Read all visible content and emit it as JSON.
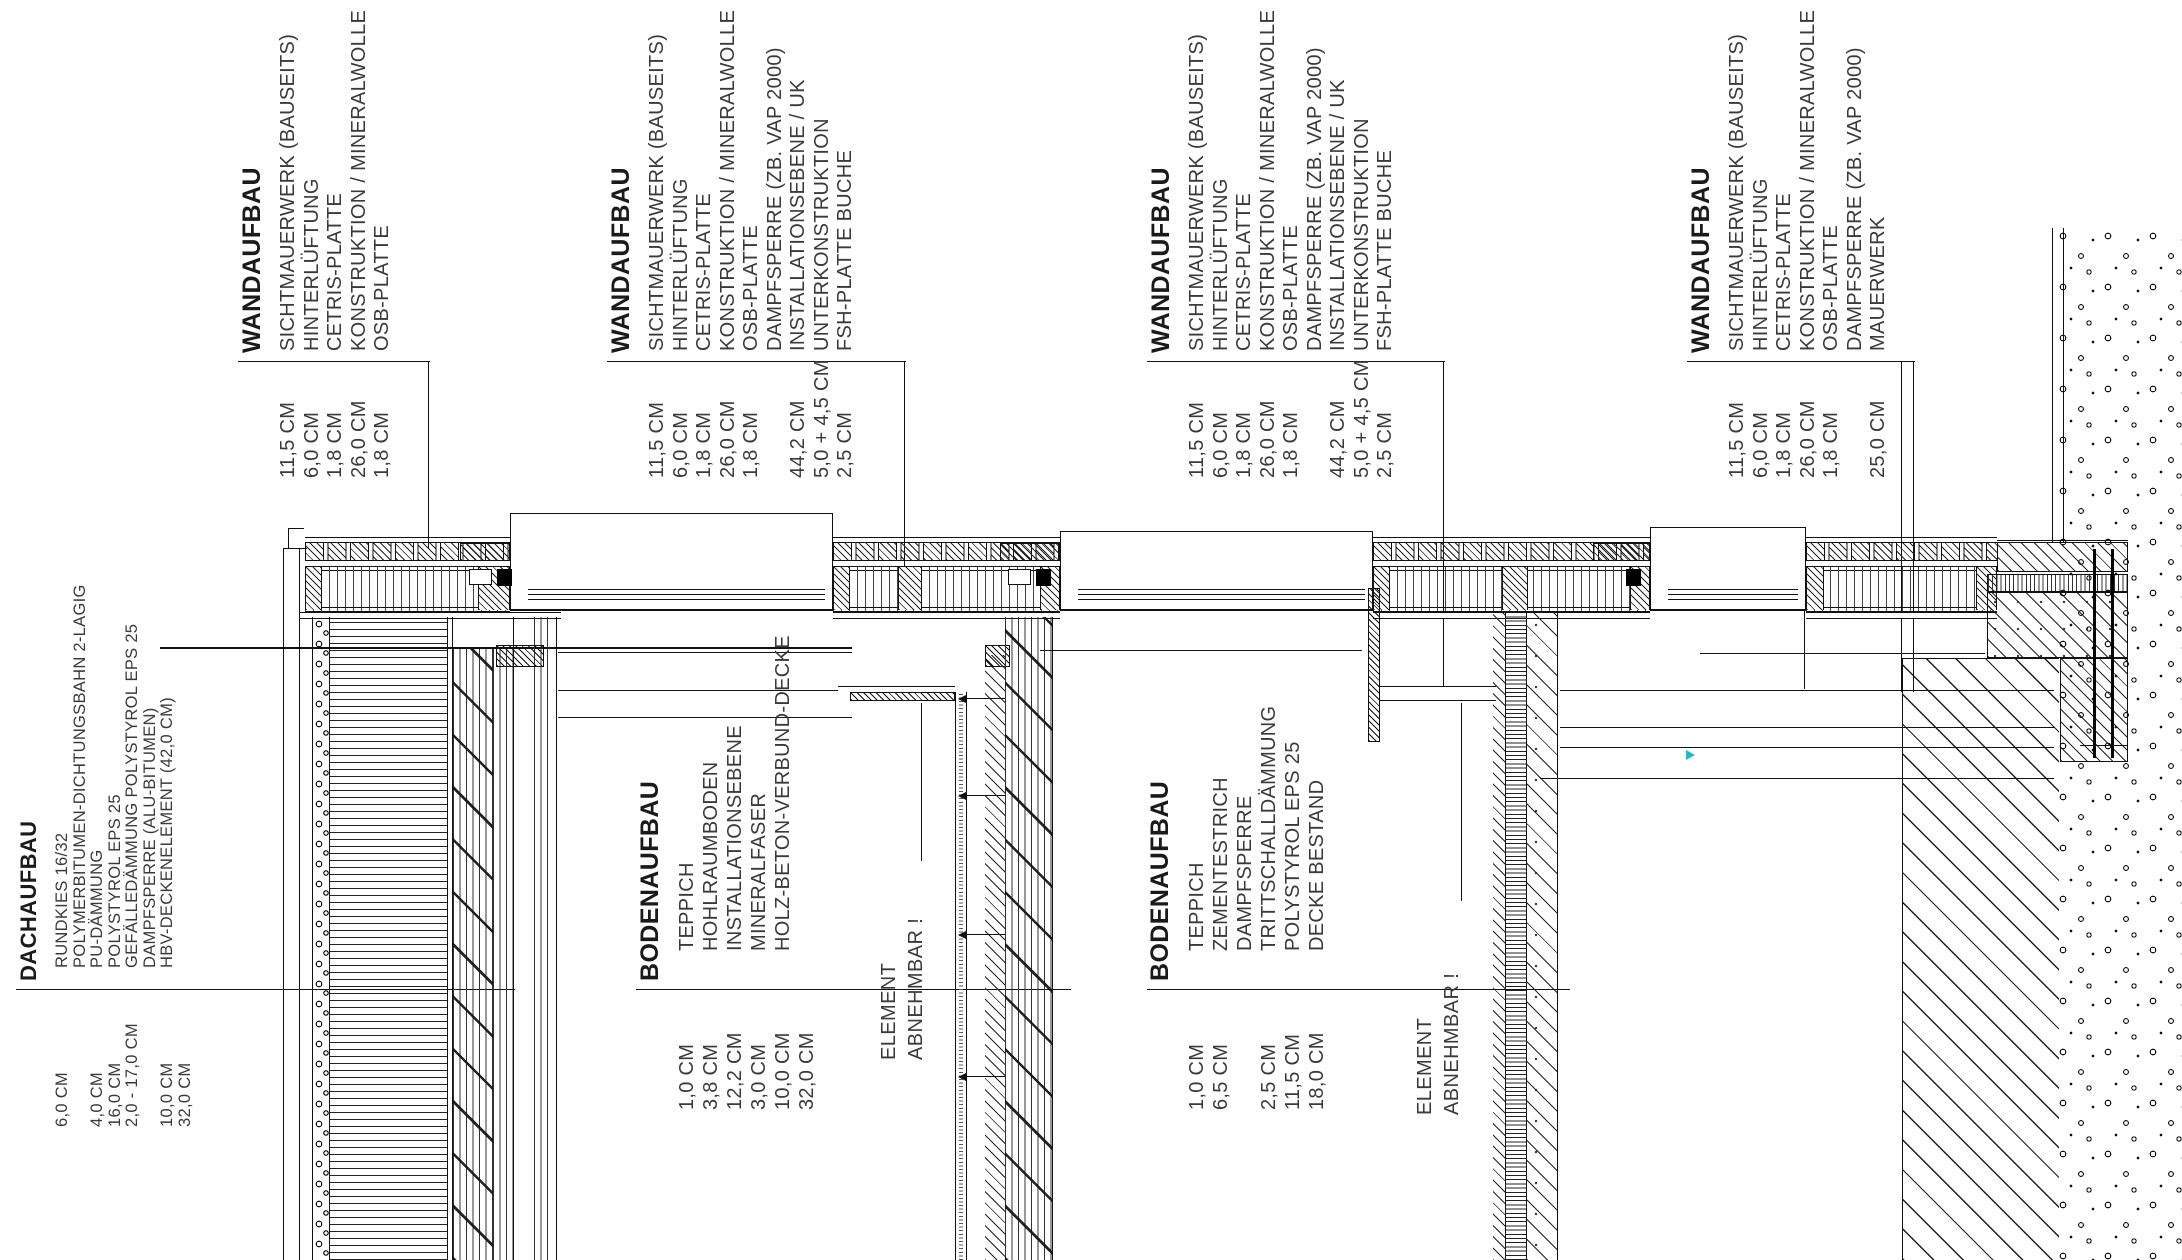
{
  "legend_blocks": [
    {
      "id": "dachaufbau",
      "heading": "DACHAUFBAU",
      "rows": [
        {
          "dim": "6,0 CM",
          "label": "RUNDKIES 16/32"
        },
        {
          "dim": "",
          "label": "POLYMERBITUMEN-DICHTUNGSBAHN 2-LAGIG"
        },
        {
          "dim": "4,0 CM",
          "label": "PU-DÄMMUNG"
        },
        {
          "dim": "16,0 CM",
          "label": "POLYSTYROL EPS 25"
        },
        {
          "dim": "2,0 - 17,0 CM",
          "label": "GEFÄLLEDÄMMUNG POLYSTYROL EPS 25"
        },
        {
          "dim": "",
          "label": "DAMPFSPERRE (ALU-BITUMEN)"
        },
        {
          "dim": "10,0 CM",
          "label": "HBV-DECKENELEMENT (42,0 CM)"
        },
        {
          "dim": "32,0 CM",
          "label": ""
        }
      ]
    },
    {
      "id": "wandaufbau-1",
      "heading": "WANDAUFBAU",
      "rows": [
        {
          "dim": "11,5 CM",
          "label": "SICHTMAUERWERK (BAUSEITS)"
        },
        {
          "dim": "6,0 CM",
          "label": "HINTERLÜFTUNG"
        },
        {
          "dim": "1,8 CM",
          "label": "CETRIS-PLATTE"
        },
        {
          "dim": "26,0 CM",
          "label": "KONSTRUKTION / MINERALWOLLE"
        },
        {
          "dim": "1,8 CM",
          "label": "OSB-PLATTE"
        }
      ]
    },
    {
      "id": "wandaufbau-2",
      "heading": "WANDAUFBAU",
      "rows": [
        {
          "dim": "11,5 CM",
          "label": "SICHTMAUERWERK (BAUSEITS)"
        },
        {
          "dim": "6,0 CM",
          "label": "HINTERLÜFTUNG"
        },
        {
          "dim": "1,8 CM",
          "label": "CETRIS-PLATTE"
        },
        {
          "dim": "26,0 CM",
          "label": "KONSTRUKTION / MINERALWOLLE"
        },
        {
          "dim": "1,8 CM",
          "label": "OSB-PLATTE"
        },
        {
          "dim": "",
          "label": "DAMPFSPERRE (ZB. VAP 2000)"
        },
        {
          "dim": "44,2 CM",
          "label": "INSTALLATIONSEBENE / UK"
        },
        {
          "dim": "5,0 + 4,5 CM",
          "label": "UNTERKONSTRUKTION"
        },
        {
          "dim": "2,5 CM",
          "label": "FSH-PLATTE BUCHE"
        }
      ]
    },
    {
      "id": "wandaufbau-3",
      "heading": "WANDAUFBAU",
      "rows": [
        {
          "dim": "11,5 CM",
          "label": "SICHTMAUERWERK (BAUSEITS)"
        },
        {
          "dim": "6,0 CM",
          "label": "HINTERLÜFTUNG"
        },
        {
          "dim": "1,8 CM",
          "label": "CETRIS-PLATTE"
        },
        {
          "dim": "26,0 CM",
          "label": "KONSTRUKTION / MINERALWOLLE"
        },
        {
          "dim": "1,8 CM",
          "label": "OSB-PLATTE"
        },
        {
          "dim": "",
          "label": "DAMPFSPERRE (ZB. VAP 2000)"
        },
        {
          "dim": "44,2 CM",
          "label": "INSTALLATIONSEBENE / UK"
        },
        {
          "dim": "5,0 + 4,5 CM",
          "label": "UNTERKONSTRUKTION"
        },
        {
          "dim": "2,5 CM",
          "label": "FSH-PLATTE BUCHE"
        }
      ]
    },
    {
      "id": "wandaufbau-4",
      "heading": "WANDAUFBAU",
      "rows": [
        {
          "dim": "11,5 CM",
          "label": "SICHTMAUERWERK (BAUSEITS)"
        },
        {
          "dim": "6,0 CM",
          "label": "HINTERLÜFTUNG"
        },
        {
          "dim": "1,8 CM",
          "label": "CETRIS-PLATTE"
        },
        {
          "dim": "26,0 CM",
          "label": "KONSTRUKTION / MINERALWOLLE"
        },
        {
          "dim": "1,8 CM",
          "label": "OSB-PLATTE"
        },
        {
          "dim": "",
          "label": "DAMPFSPERRE (ZB. VAP 2000)"
        },
        {
          "dim": "25,0 CM",
          "label": "MAUERWERK"
        }
      ]
    },
    {
      "id": "bodenaufbau-1",
      "heading": "BODENAUFBAU",
      "rows": [
        {
          "dim": "1,0 CM",
          "label": "TEPPICH"
        },
        {
          "dim": "3,8 CM",
          "label": "HOHLRAUMBODEN"
        },
        {
          "dim": "12,2 CM",
          "label": "INSTALLATIONSEBENE"
        },
        {
          "dim": "3,0 CM",
          "label": "MINERALFASER"
        },
        {
          "dim": "10,0 CM",
          "label": "HOLZ-BETON-VERBUND-DECKE"
        },
        {
          "dim": "32,0 CM",
          "label": ""
        }
      ]
    },
    {
      "id": "bodenaufbau-2",
      "heading": "BODENAUFBAU",
      "rows": [
        {
          "dim": "1,0 CM",
          "label": "TEPPICH"
        },
        {
          "dim": "6,5 CM",
          "label": "ZEMENTESTRICH"
        },
        {
          "dim": "",
          "label": "DAMPFSPERRE"
        },
        {
          "dim": "2,5 CM",
          "label": "TRITTSCHALLDÄMMUNG"
        },
        {
          "dim": "11,5 CM",
          "label": "POLYSTYROL EPS 25"
        },
        {
          "dim": "18,0 CM",
          "label": "DECKE BESTAND"
        }
      ]
    }
  ],
  "notes": [
    {
      "id": "element-1",
      "lines": [
        "ELEMENT",
        "ABNEHMBAR !"
      ]
    },
    {
      "id": "element-2",
      "lines": [
        "ELEMENT",
        "ABNEHMBAR !"
      ]
    }
  ],
  "colors": {
    "line": "#111111",
    "text": "#3a3a3a",
    "marker": "#1dbdbd"
  }
}
